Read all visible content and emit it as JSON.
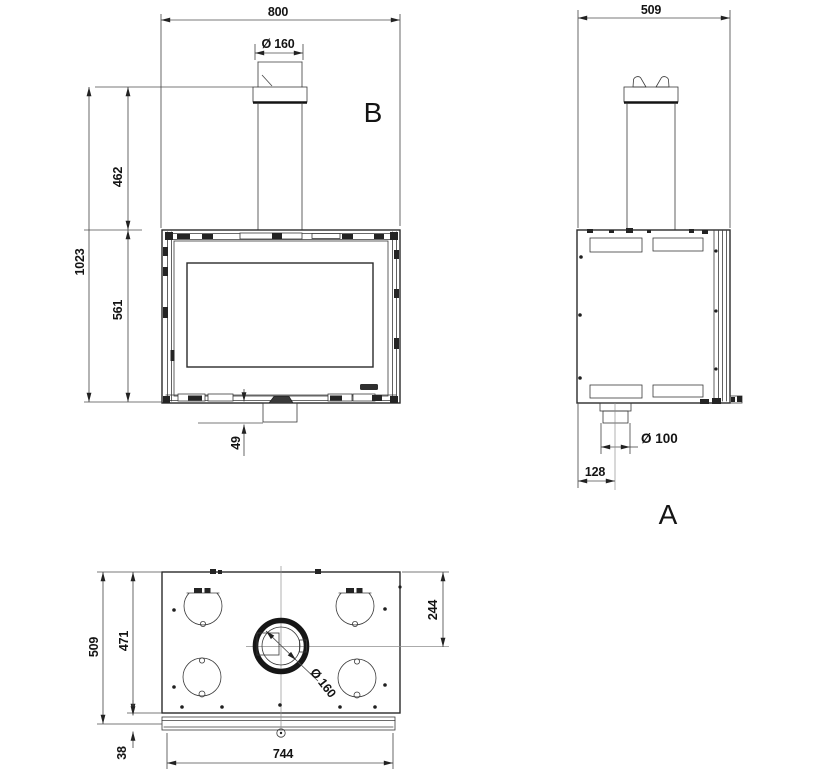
{
  "views": {
    "front": {
      "label": "B",
      "dim_width": "800",
      "dim_flue_diameter": "Ø 160",
      "dim_total_height": "1023",
      "dim_flue_height": "462",
      "dim_body_height": "561",
      "dim_base_drop": "49"
    },
    "side": {
      "label": "A",
      "dim_depth": "509",
      "dim_outlet_diameter": "Ø 100",
      "dim_outlet_offset": "128"
    },
    "top": {
      "dim_depth": "509",
      "dim_body_depth": "471",
      "dim_frame_thickness": "38",
      "dim_front_width": "744",
      "dim_flue_center_offset": "244",
      "dim_flue_diameter": "Ø 160"
    }
  }
}
